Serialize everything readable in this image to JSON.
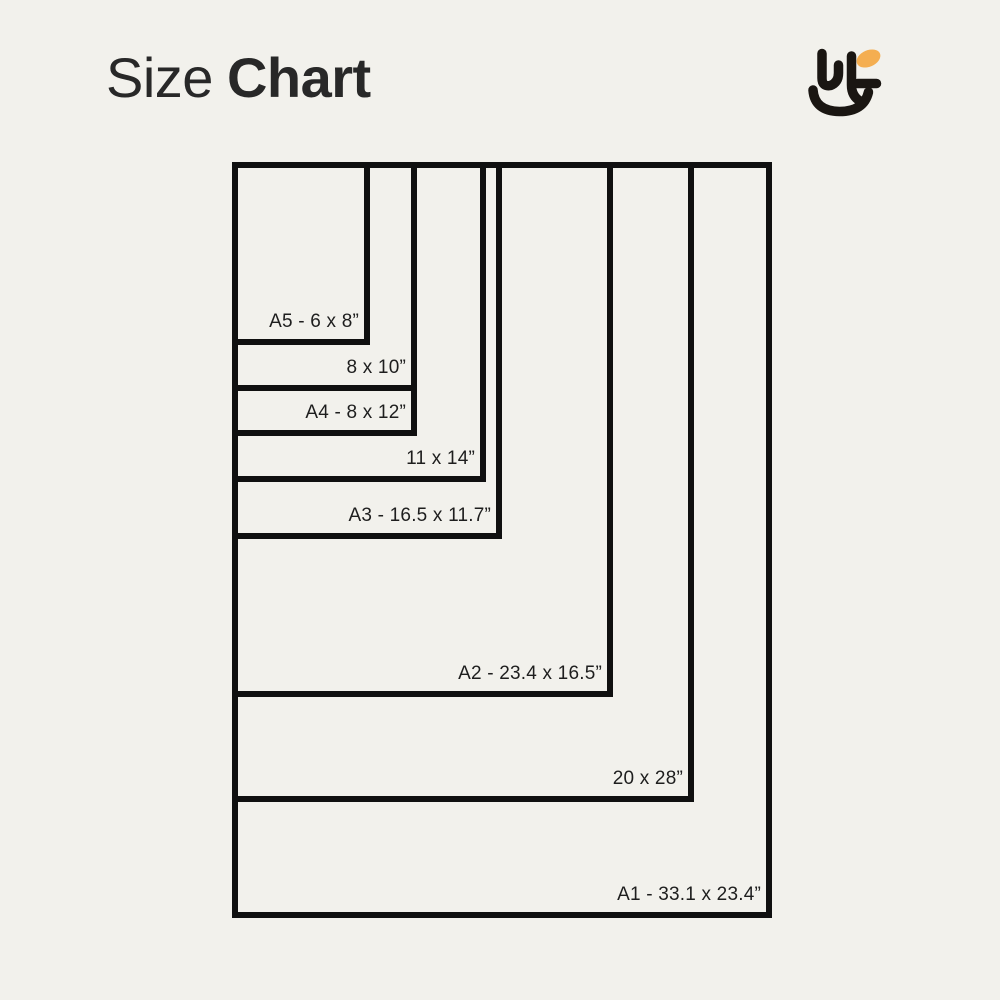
{
  "header": {
    "title_light": "Size",
    "title_bold": "Chart"
  },
  "logo": {
    "ink_color": "#1a1612",
    "accent_color": "#f4ae51"
  },
  "chart_data": {
    "type": "nested_rectangles",
    "title": "Size Chart",
    "unit": "inches",
    "anchor": "top-left",
    "grid": false,
    "label_position": "inside-bottom-right-of-each-rectangle",
    "line_color": "#101010",
    "label_color": "#1e1e1e",
    "background": "#f2f1ec",
    "sizes": [
      {
        "id": "a5",
        "label": "A5 - 6 x 8”",
        "width_in": 6,
        "height_in": 8
      },
      {
        "id": "8x10",
        "label": "8 x 10”",
        "width_in": 8,
        "height_in": 10
      },
      {
        "id": "a4",
        "label": "A4 - 8 x 12”",
        "width_in": 8,
        "height_in": 12
      },
      {
        "id": "11x14",
        "label": "11 x 14”",
        "width_in": 11,
        "height_in": 14
      },
      {
        "id": "a3",
        "label": "A3 - 16.5 x 11.7”",
        "width_in": 11.7,
        "height_in": 16.5
      },
      {
        "id": "a2",
        "label": "A2 - 23.4 x 16.5”",
        "width_in": 16.5,
        "height_in": 23.4
      },
      {
        "id": "20x28",
        "label": "20 x 28”",
        "width_in": 20,
        "height_in": 28
      },
      {
        "id": "a1",
        "label": "A1 - 33.1 x 23.4”",
        "width_in": 23.4,
        "height_in": 33.1
      }
    ]
  }
}
